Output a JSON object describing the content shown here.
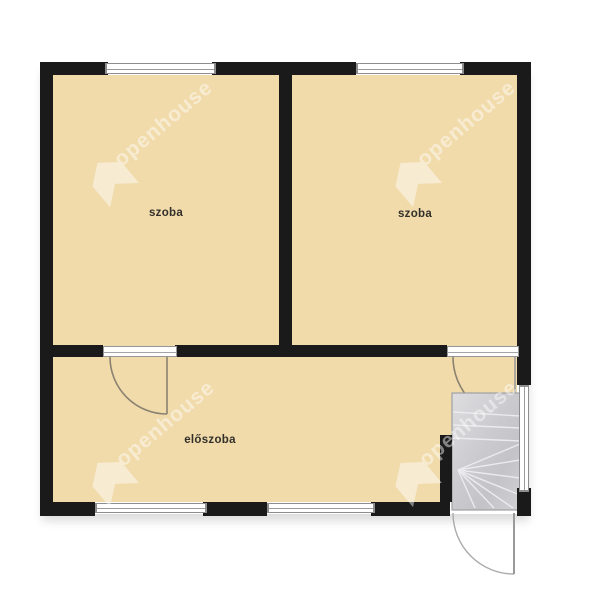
{
  "plan": {
    "type": "floor-plan",
    "rooms": [
      {
        "id": "room-left",
        "label": "szoba"
      },
      {
        "id": "room-right",
        "label": "szoba"
      },
      {
        "id": "hall",
        "label": "előszoba"
      }
    ],
    "features": [
      "windows",
      "doors",
      "winder-staircase"
    ]
  },
  "watermark": {
    "text": "openhouse"
  },
  "colors": {
    "room_fill": "#f1dbab",
    "wall": "#1a1a1a",
    "stair_fill": "#cfcfd2",
    "door_arc": "#8a8170",
    "frame_line": "#8e8e8e",
    "label_text": "#33302a",
    "background": "#ffffff"
  }
}
